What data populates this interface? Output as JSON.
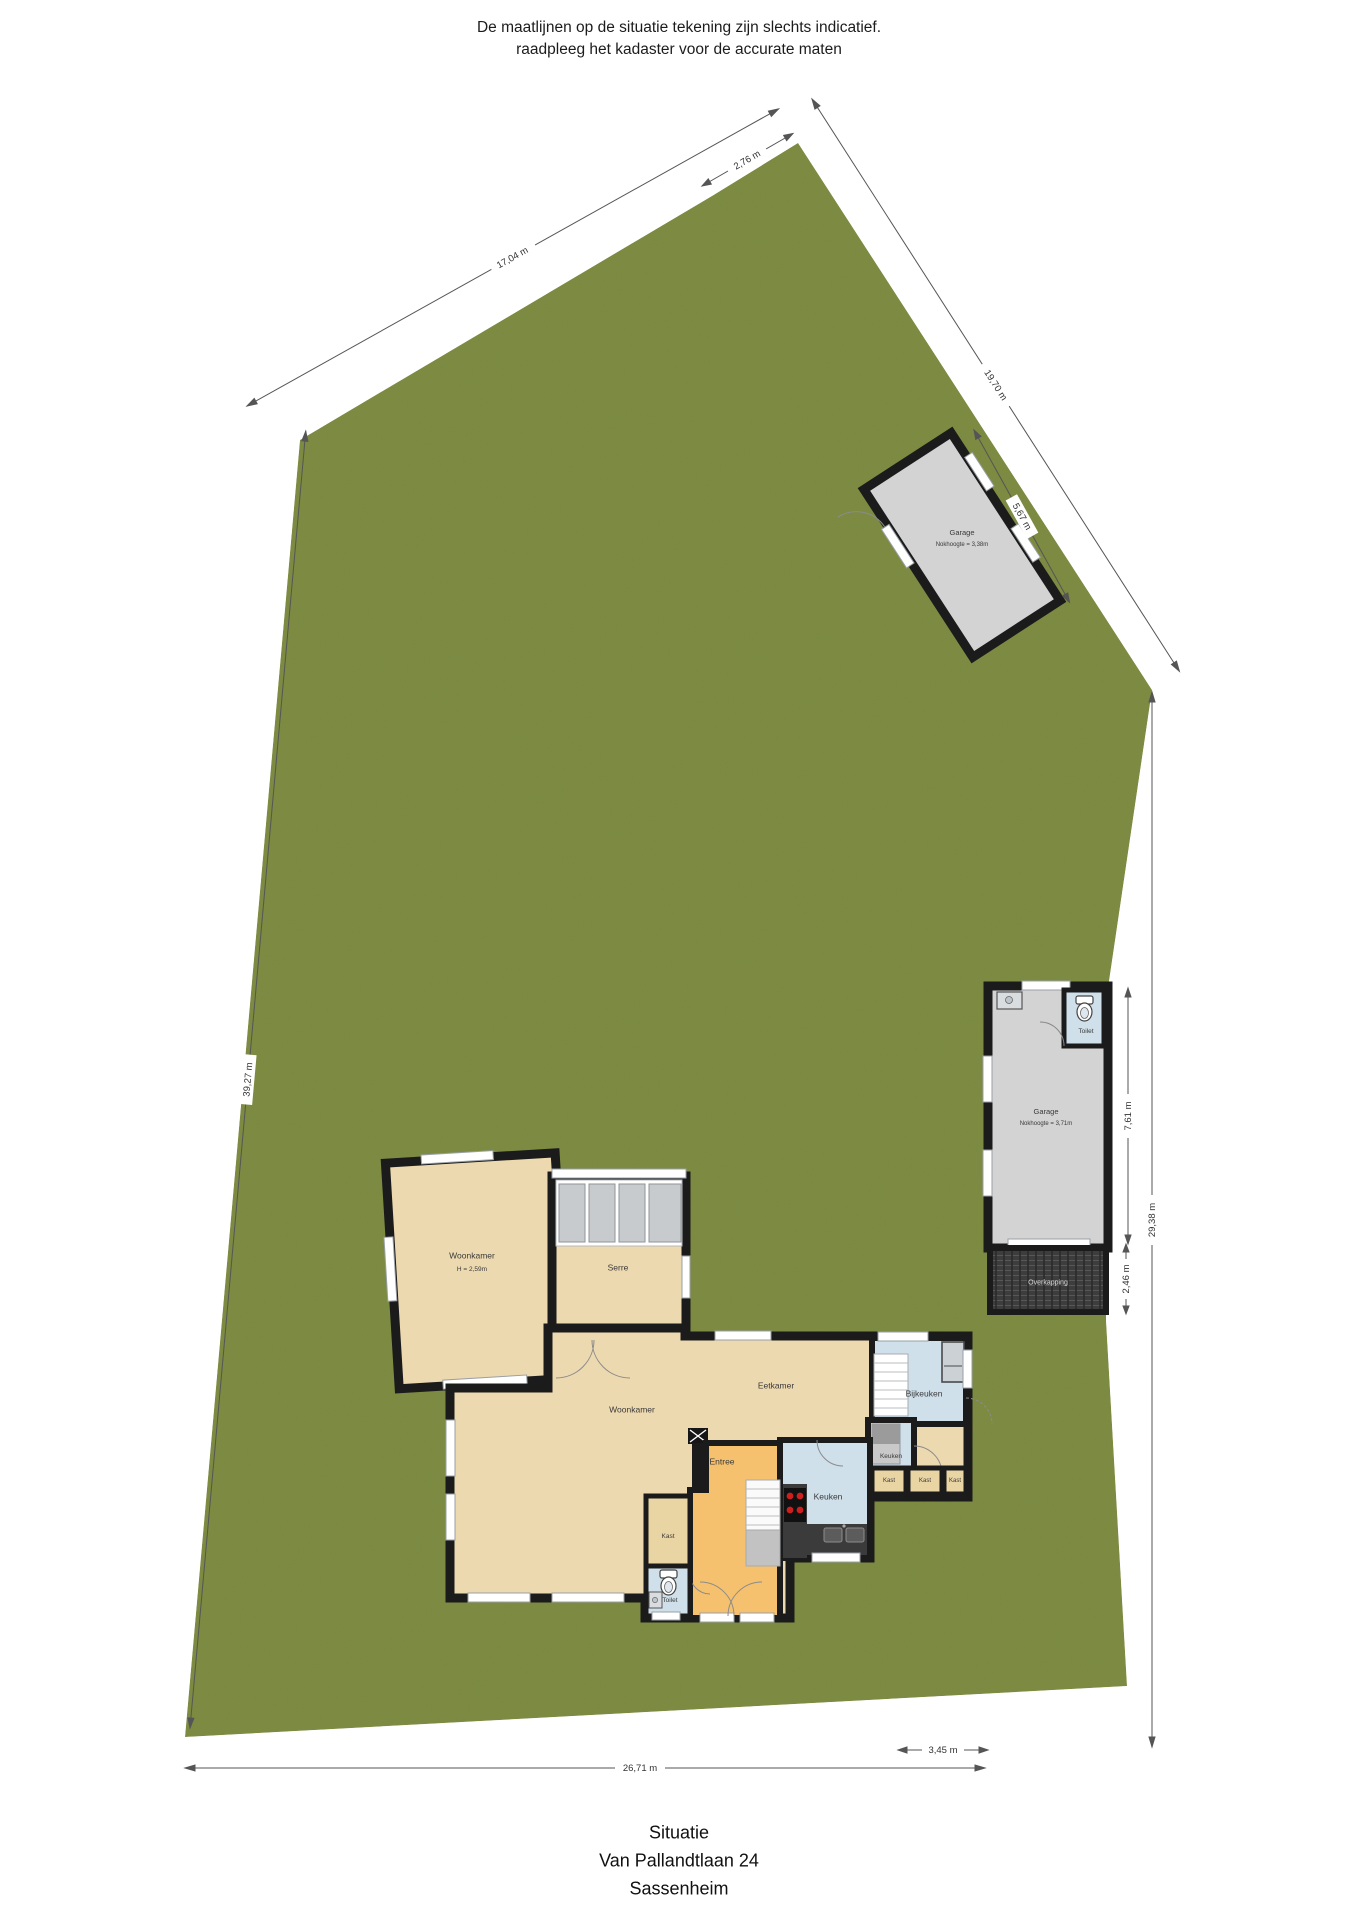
{
  "disclaimer": {
    "line1": "De maatlijnen op de situatie tekening zijn slechts indicatief.",
    "line2": "raadpleeg het kadaster voor de accurate maten"
  },
  "title": {
    "line1": "Situatie",
    "line2": "Van Pallandtlaan 24",
    "line3": "Sassenheim"
  },
  "rooms": {
    "woonkamer_upper": {
      "label": "Woonkamer",
      "sub": "H = 2,59m"
    },
    "serre": {
      "label": "Serre"
    },
    "eetkamer": {
      "label": "Eetkamer"
    },
    "woonkamer": {
      "label": "Woonkamer"
    },
    "bijkeuken": {
      "label": "Bijkeuken"
    },
    "keuken": {
      "label": "Keuken"
    },
    "keuken_small": {
      "label": "Keuken"
    },
    "entree": {
      "label": "Entree"
    },
    "toilet": {
      "label": "Toilet"
    },
    "kast_hal": {
      "label": "Kast"
    },
    "kast_row": [
      "Kast",
      "Kast",
      "Kast"
    ],
    "garage_top": {
      "label": "Garage",
      "sub": "Nokhoogte = 3,38m"
    },
    "garage_right": {
      "label": "Garage",
      "sub": "Nokhoogte = 3,71m"
    },
    "toilet_garage": {
      "label": "Toilet"
    },
    "overkapping": {
      "label": "Overkapping"
    }
  },
  "dimensions": [
    {
      "id": "top-left-edge",
      "label": "17,04 m"
    },
    {
      "id": "top-edge",
      "label": "2,76 m"
    },
    {
      "id": "upper-right-edge",
      "label": "19,70 m"
    },
    {
      "id": "garage-top-edge",
      "label": "5,67 m"
    },
    {
      "id": "left-edge",
      "label": "39,27 m"
    },
    {
      "id": "right-edge",
      "label": "29,38 m"
    },
    {
      "id": "garage-right-height",
      "label": "7,61 m"
    },
    {
      "id": "overkapping-height",
      "label": "2,46 m"
    },
    {
      "id": "bottom-edge",
      "label": "26,71 m"
    },
    {
      "id": "bottom-right-segment",
      "label": "3,45 m"
    }
  ],
  "icons": {
    "toilet": "toilet-icon",
    "sink": "sink-icon",
    "cooktop": "cooktop-icon",
    "fridge": "fridge-icon",
    "stairs": "stairs-icon"
  },
  "colors": {
    "grass": "#7A8A43",
    "floor_tan": "#EDD9AF",
    "floor_blue": "#CFE0EB",
    "floor_orange": "#F6C16E",
    "garage_gray": "#D3D3D3",
    "wall": "#1B1B1B",
    "overkapping": "#3D3D3D"
  }
}
